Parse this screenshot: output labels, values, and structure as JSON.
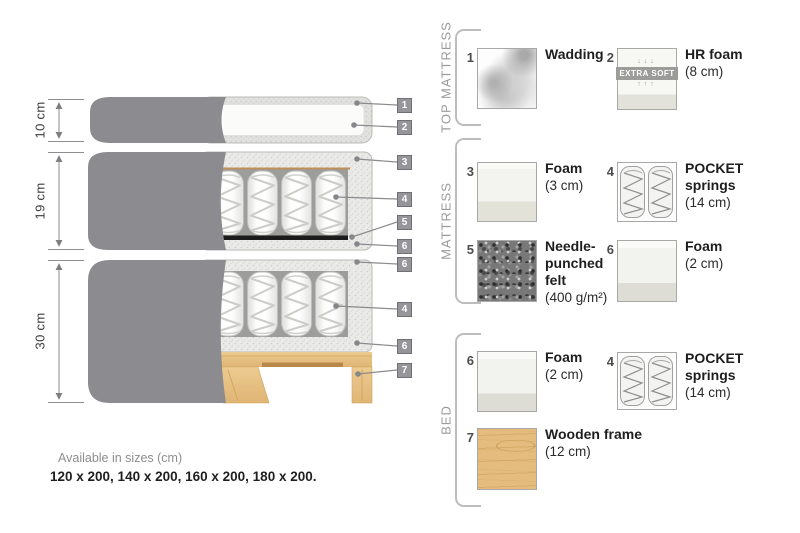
{
  "diagram": {
    "measurements": [
      {
        "label": "10 cm"
      },
      {
        "label": "19 cm"
      },
      {
        "label": "30 cm"
      }
    ],
    "callouts": [
      {
        "num": "1"
      },
      {
        "num": "2"
      },
      {
        "num": "3"
      },
      {
        "num": "4"
      },
      {
        "num": "5"
      },
      {
        "num": "6"
      },
      {
        "num": "6"
      },
      {
        "num": "4"
      },
      {
        "num": "6"
      },
      {
        "num": "7"
      }
    ]
  },
  "legend": {
    "sections": [
      {
        "title": "TOP MATTRESS",
        "items": [
          {
            "num": "1",
            "name_lines": [
              "Wadding"
            ],
            "dim": ""
          },
          {
            "num": "2",
            "name_lines": [
              "HR foam"
            ],
            "dim": "(8 cm)",
            "extra_label": "EXTRA SOFT",
            "arrows_down": "↓↓↓",
            "arrows_up": "↑↑↑"
          }
        ]
      },
      {
        "title": "MATTRESS",
        "items": [
          {
            "num": "3",
            "name_lines": [
              "Foam"
            ],
            "dim": "(3 cm)"
          },
          {
            "num": "4",
            "name_lines": [
              "POCKET",
              "springs"
            ],
            "dim": "(14 cm)"
          },
          {
            "num": "5",
            "name_lines": [
              "Needle-",
              "punched",
              "felt"
            ],
            "dim": "(400 g/m²)"
          },
          {
            "num": "6",
            "name_lines": [
              "Foam"
            ],
            "dim": "(2 cm)"
          }
        ]
      },
      {
        "title": "BED",
        "items": [
          {
            "num": "6",
            "name_lines": [
              "Foam"
            ],
            "dim": "(2 cm)"
          },
          {
            "num": "4",
            "name_lines": [
              "POCKET",
              "springs"
            ],
            "dim": "(14 cm)"
          },
          {
            "num": "7",
            "name_lines": [
              "Wooden frame"
            ],
            "dim": "(12 cm)"
          }
        ]
      }
    ]
  },
  "footer": {
    "line1": "Available in sizes (cm)",
    "line2": "120 x 200, 140 x 200, 160 x 200, 180 x 200."
  },
  "colors": {
    "cover_gray": "#8c8c90",
    "foam_speckle": "#eaeae8",
    "felt_black": "#1b1b1b",
    "wood_tan": "#e7c287",
    "leader_gray": "#8b8b8f"
  }
}
